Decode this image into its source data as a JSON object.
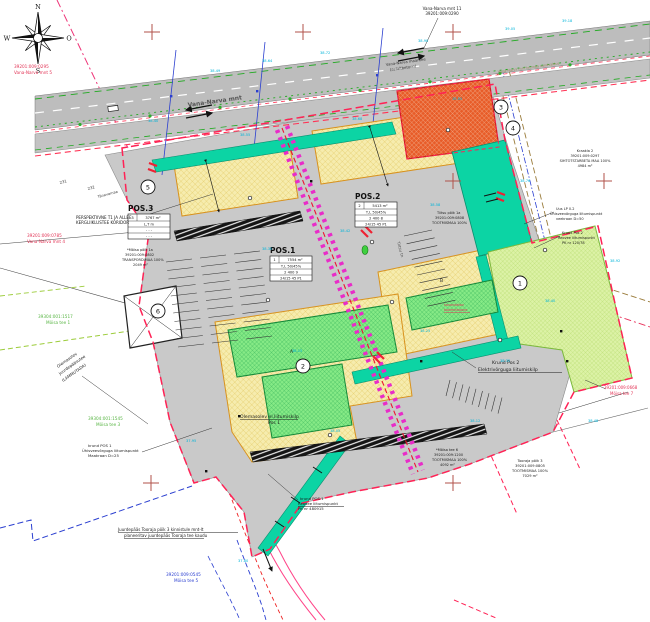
{
  "compass": {
    "n": "N",
    "e": "O",
    "s": "S",
    "w": "W"
  },
  "tables": {
    "pos1": {
      "title": "POS.1",
      "num": "1",
      "area": "7554 m²",
      "rows": [
        "T,L  50/45%",
        "2    400    9",
        "24/15  45  P1"
      ]
    },
    "pos2": {
      "title": "POS.2",
      "num": "2",
      "area": "5413 m²",
      "rows": [
        "T,L  50/45%",
        "2    400    8",
        "24/15  45  P1"
      ]
    },
    "pos3": {
      "title": "POS.3",
      "num": "3",
      "area": "3767 m²",
      "rows": [
        "L,T   m",
        "-    -    -",
        "-    -    -"
      ]
    }
  },
  "circles": {
    "c1": "1",
    "c2": "2",
    "c3": "3",
    "c4": "4",
    "c5": "5",
    "c6": "6"
  },
  "labels": {
    "vn5_code": "39201:009:0295",
    "vn5_name": "Vana-Narva mnt 5",
    "vn11_name": "Vana-Narva mnt 11",
    "vn11_code": "39201:009:0290",
    "road_main": "Vana-Narva mnt",
    "road_main2": "Vana-Narva maantee",
    "road_main3": "(asfaltbetoon)",
    "sundvaldus": "Vana-Narva mnt teemaa sundvaldus",
    "persp1": "PERSPEKTIIVNE T1 JA ALLEE",
    "persp2": "KERGLIIKLUSTEE KORIDOR",
    "vn4_code": "39201:009:0785",
    "vn4_name": "Vana-Narva mnt 4",
    "moisa1_code": "39304:001:1517",
    "moisa1_name": "Mõisa tee 1",
    "demol1": "Olemasolev",
    "demol2": "juurdepääsutee",
    "demol3": "(LAMMUTADA)",
    "moisa3_code": "39304:001:1545",
    "moisa3_name": "Mõisa tee 3",
    "water1": "krund POS 1",
    "water2": "Ühisveevõrguga liitumispunkt",
    "water3": "Maakraan D=25",
    "access1": "Juurdepääs Tooraja põik 3 kinnistule mnt-lt",
    "access2": "planeeritav juurdepääs Tooraja tee kaudu",
    "moisa5_code": "39201:009:0545",
    "moisa5_name": "Mõisa tee 5",
    "elkilp1": "Olemasolev el.liitumiskilp",
    "elkilp2": "Pos 1",
    "sewer1": "krund POS 1",
    "sewer2": "Reovee liitumispunkt",
    "sewer3": "PK nr 480915",
    "moisapoik1": "*Mõisa põik 1a",
    "moisapoik2": "39201:009:0802",
    "moisapoik3": "TRANSPORDIMAA 100%",
    "moisapoik4": "2049 m²",
    "tiitsu1": "Tiitsu põik 1a",
    "tiitsu2": "39201:009:0808",
    "tiitsu3": "TOOTMISMAA 100%",
    "kraakla1": "Kraakla 2",
    "kraakla2": "39201:009:0297",
    "kraakla3": "SIHTOTSTARBETA MAA 100%",
    "kraakla4": "4984 m²",
    "uuslp1": "Uus LP 0.2",
    "uuslp2": "Ühisveevõrguga liitumispunkt",
    "uuslp3": "veekraan D=50",
    "pos2reovee1": "Krund Pos 2",
    "pos2reovee2": "Reovee liitumispunkt",
    "pos2reovee3": "PK nr 120/78",
    "pos2el1": "Krund Pos 2",
    "pos2el2": "Elektrivõrguga liitumiskilp",
    "moisa6_1": "*Mõisa tee 6",
    "moisa6_2": "39201:009:1200",
    "moisa6_3": "TOOTMISMAA 100%",
    "moisa6_4": "4092 m²",
    "tooraja1": "Tooraja põik 3",
    "tooraja2": "39201:009:0805",
    "tooraja3": "TOOTMISMAA 100%",
    "tooraja4": "7029 m²",
    "moisa7_code": "39201:009:0668",
    "moisa7_name": "Mõisa tee 7",
    "bld_red1": "kavandatav",
    "bld_red2": "tootmishoone",
    "street_tiitsu": "Tiitsu tn",
    "tanavamaa": "Tänavamaa",
    "plot231": "231",
    "plot232": "232",
    "letterA": "A",
    "letterB": "B"
  },
  "elevations": [
    "38.49",
    "38.64",
    "38.72",
    "38.90",
    "39.05",
    "39.18",
    "38.40",
    "38.55",
    "38.68",
    "38.85",
    "38.30",
    "38.42",
    "38.58",
    "38.76",
    "38.15",
    "38.25",
    "38.40",
    "37.95",
    "38.05",
    "38.12",
    "38.48",
    "37.80",
    "38.92",
    "38.35"
  ],
  "colors": {
    "boundary": "#ff2255",
    "planned_street": "#e82cc8",
    "teal_zone": "#0cd4a4",
    "yellow_parcel": "#f6ecae",
    "green_building": "#86ea86",
    "light_green_zone": "#dcf2a6",
    "orange_parcel": "#e85c28",
    "road_gray": "#bdbdbd",
    "site_gray": "#c9c9c9",
    "elevation_text": "#00b4d9",
    "cadastral_red": "#e23355",
    "cadastral_green": "#58b544",
    "cadastral_blue": "#2b3fd0"
  }
}
